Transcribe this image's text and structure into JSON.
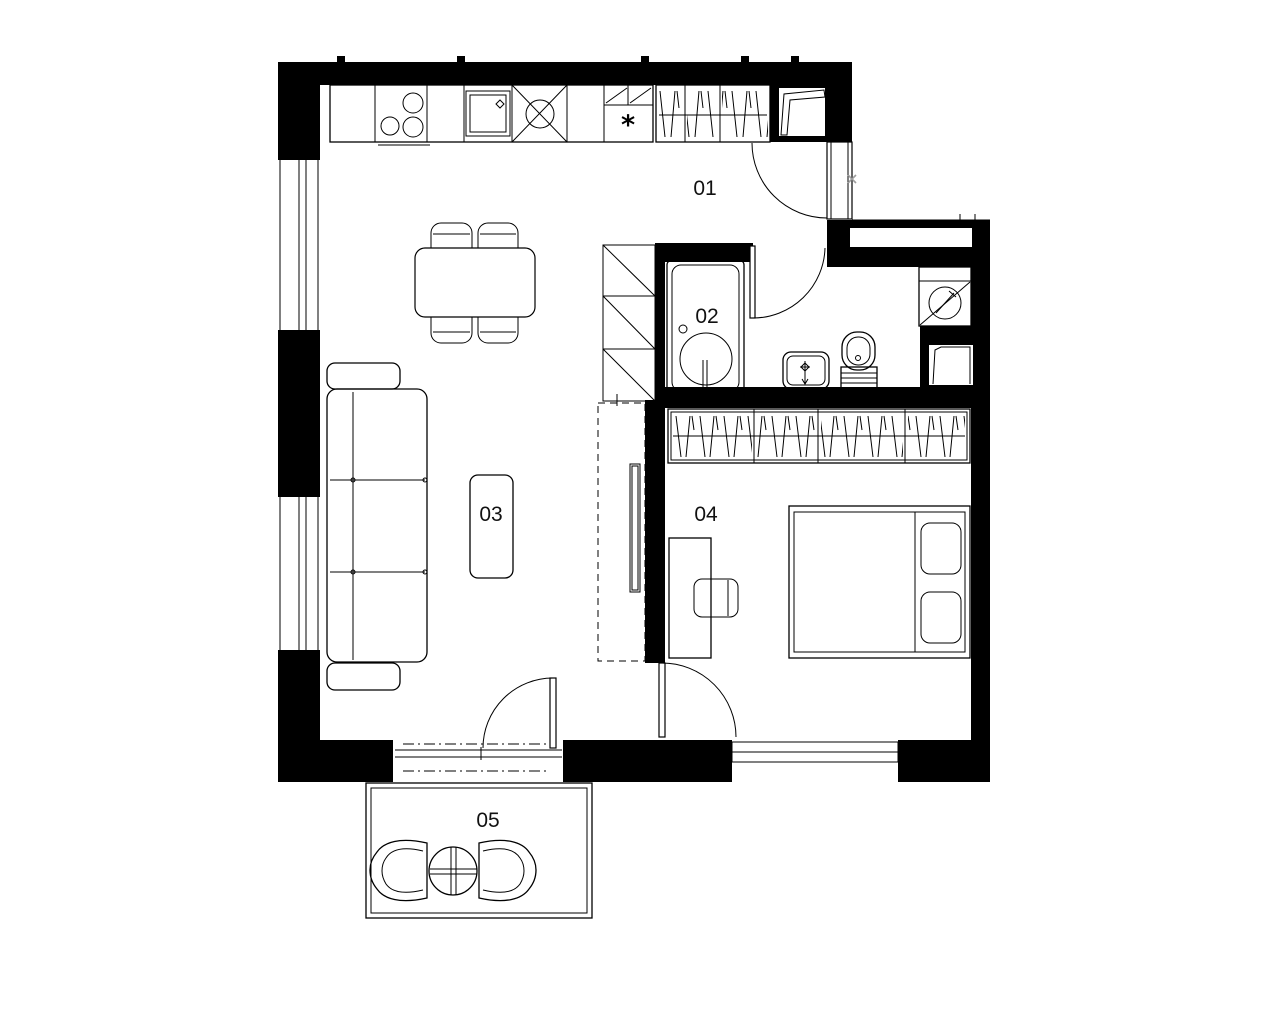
{
  "plan": {
    "title": "apartment floor plan",
    "rooms": [
      {
        "number": "01",
        "name": "hall-kitchen"
      },
      {
        "number": "02",
        "name": "bathroom"
      },
      {
        "number": "03",
        "name": "living-room"
      },
      {
        "number": "04",
        "name": "bedroom"
      },
      {
        "number": "05",
        "name": "balcony"
      }
    ],
    "symbols": {
      "refrigerator_mark": "*"
    },
    "colors": {
      "wall_fill": "#000000",
      "line": "#000000",
      "background": "#ffffff",
      "dimension_mark": "#9e9e9e"
    }
  }
}
